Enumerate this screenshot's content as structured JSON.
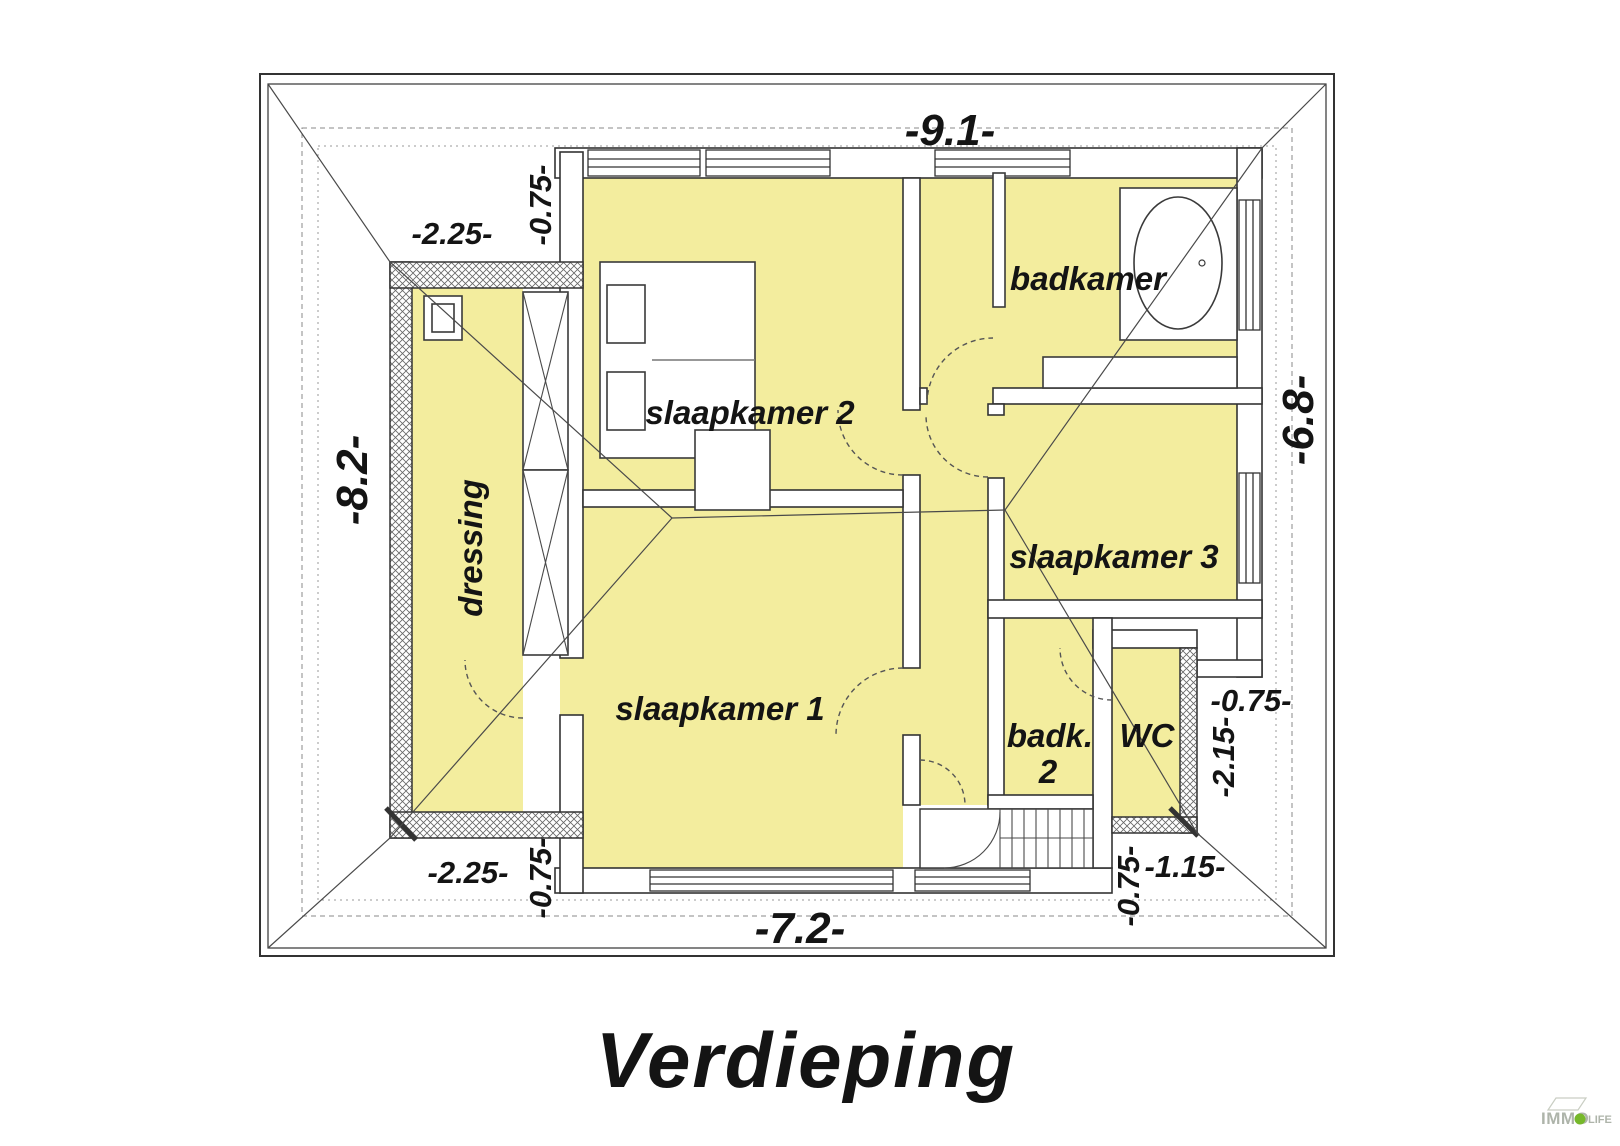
{
  "title": "Verdieping",
  "rooms": {
    "slaapkamer2": "slaapkamer 2",
    "badkamer": "badkamer",
    "dressing": "dressing",
    "slaapkamer1": "slaapkamer 1",
    "slaapkamer3": "slaapkamer 3",
    "badk2_line1": "badk.",
    "badk2_line2": "2",
    "wc": "WC"
  },
  "dimensions": {
    "top_width": "-9.1-",
    "top_left_width": "-2.25-",
    "top_left_offset": "-0.75-",
    "left_height": "-8.2-",
    "right_height": "-6.8-",
    "bottom_width": "-7.2-",
    "bottom_left_width": "-2.25-",
    "bottom_left_offset": "-0.75-",
    "right_roof_offset": "-0.75-",
    "wc_side_height": "-2.15-",
    "bottom_right_width": "-1.15-",
    "bottom_right_offset": "-0.75-"
  },
  "logo": {
    "brand_left": "IMMO",
    "brand_right": "LIFE"
  },
  "colors": {
    "room_fill": "#F3ED9E",
    "line": "#3A3A3A",
    "logo_gray": "#AEB4AA",
    "logo_green": "#76B82A"
  }
}
